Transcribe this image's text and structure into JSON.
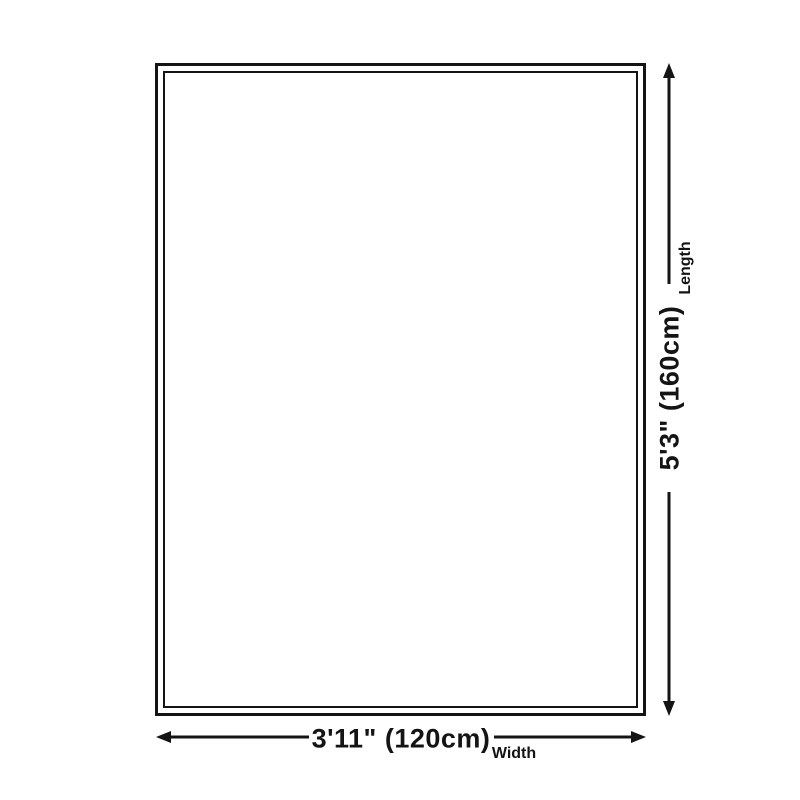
{
  "diagram": {
    "shape": "rug-outline",
    "background_color": "#ffffff",
    "line_color": "#141414",
    "length": {
      "value": "5'3\" (160cm)",
      "label": "Length"
    },
    "width": {
      "value": "3'11\" (120cm)",
      "label": "Width"
    }
  }
}
